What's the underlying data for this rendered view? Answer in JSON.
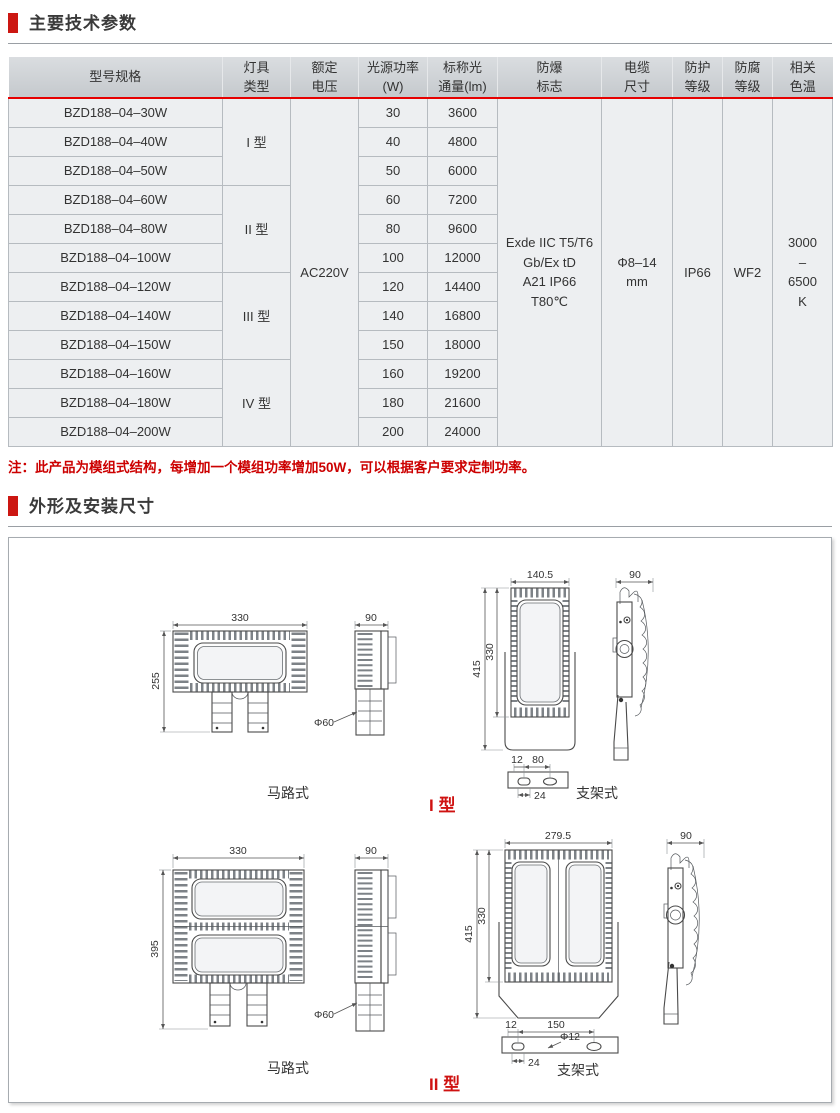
{
  "sections": {
    "params_title": "主要技术参数",
    "dims_title": "外形及安装尺寸"
  },
  "table": {
    "headers": [
      "型号规格",
      "灯具\n类型",
      "额定\n电压",
      "光源功率\n(W)",
      "标称光\n通量(lm)",
      "防爆\n标志",
      "电缆\n尺寸",
      "防护\n等级",
      "防腐\n等级",
      "相关\n色温"
    ],
    "rows": [
      {
        "model": "BZD188–04–30W",
        "power": "30",
        "flux": "3600"
      },
      {
        "model": "BZD188–04–40W",
        "power": "40",
        "flux": "4800"
      },
      {
        "model": "BZD188–04–50W",
        "power": "50",
        "flux": "6000"
      },
      {
        "model": "BZD188–04–60W",
        "power": "60",
        "flux": "7200"
      },
      {
        "model": "BZD188–04–80W",
        "power": "80",
        "flux": "9600"
      },
      {
        "model": "BZD188–04–100W",
        "power": "100",
        "flux": "12000"
      },
      {
        "model": "BZD188–04–120W",
        "power": "120",
        "flux": "14400"
      },
      {
        "model": "BZD188–04–140W",
        "power": "140",
        "flux": "16800"
      },
      {
        "model": "BZD188–04–150W",
        "power": "150",
        "flux": "18000"
      },
      {
        "model": "BZD188–04–160W",
        "power": "160",
        "flux": "19200"
      },
      {
        "model": "BZD188–04–180W",
        "power": "180",
        "flux": "21600"
      },
      {
        "model": "BZD188–04–200W",
        "power": "200",
        "flux": "24000"
      }
    ],
    "groups": [
      {
        "label": "I 型"
      },
      {
        "label": "II 型"
      },
      {
        "label": "III 型"
      },
      {
        "label": "IV 型"
      }
    ],
    "voltage": "AC220V",
    "ex_mark": "Exde IIC T5/T6\nGb/Ex tD\nA21 IP66\nT80℃",
    "cable_size": "Φ8–14\nmm",
    "ip_rating": "IP66",
    "corrosion_rating": "WF2",
    "color_temp": "3000\n–\n6500\nK"
  },
  "note": "注：此产品为模组式结构，每增加一个模组功率增加50W，可以根据客户要求定制功率。",
  "drawings": {
    "type1": {
      "label": "I 型",
      "road_caption": "马路式",
      "bracket_caption": "支架式",
      "road": {
        "width": "330",
        "height": "255",
        "side_width": "90",
        "pole_dia": "Φ60"
      },
      "bracket": {
        "width": "140.5",
        "body_height": "330",
        "total_height": "415",
        "side_width": "90",
        "hole_offset": "12",
        "hole_span": "80",
        "slot_width": "24"
      }
    },
    "type2": {
      "label": "II 型",
      "road_caption": "马路式",
      "bracket_caption": "支架式",
      "road": {
        "width": "330",
        "height": "395",
        "side_width": "90",
        "pole_dia": "Φ60"
      },
      "bracket": {
        "width": "279.5",
        "body_height": "330",
        "total_height": "415",
        "side_width": "90",
        "hole_offset": "12",
        "hole_span": "150",
        "hole_dia": "Φ12",
        "slot_width": "24"
      }
    }
  },
  "colors": {
    "accent_red": "#cc1712",
    "table_rule_red": "#e60000",
    "note_red": "#cc0000",
    "header_gray_top": "#dadde0",
    "header_gray_bottom": "#c5c9cd",
    "cell_gray": "#edeff1"
  }
}
